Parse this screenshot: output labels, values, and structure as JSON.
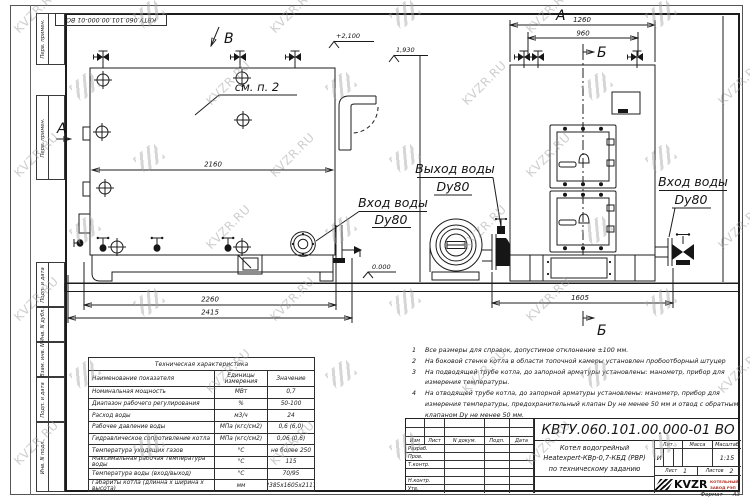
{
  "sheet": {
    "stamp_top": "КВТУ.060.101.00.000-01 ВО",
    "format_label": "Формат",
    "format_value": "А3",
    "margin_labels": [
      "Перв. примен.",
      "Перв. примен.",
      "Подп. и дата",
      "Инв. N дубл.",
      "Взам. инв. N",
      "Подп. и дата",
      "Инв. N подл."
    ]
  },
  "views": {
    "side": {
      "view_b": "В",
      "view_a": "А",
      "see_note": "см. п. 2",
      "dim_2160": "2160",
      "elev_2100": "+2,100",
      "elev_1930": "1,930",
      "inlet_line1": "Вход воды",
      "inlet_line2": "Dy80",
      "elev_zero": "0.000",
      "dim_2260": "2260",
      "dim_2415": "2415"
    },
    "front": {
      "view_a": "А",
      "dim_1260": "1260",
      "dim_960": "960",
      "section_b_top": "Б",
      "section_b_bottom": "Б",
      "outlet_line1": "Выход воды",
      "outlet_line2": "Dy80",
      "inlet_line1": "Вход воды",
      "inlet_line2": "Dy80",
      "dim_1605": "1605"
    }
  },
  "tech_table": {
    "title": "Техническая характеристика",
    "headers": [
      "Наименование показателя",
      "Единицы измерения",
      "Значение"
    ],
    "rows": [
      [
        "Номинальная мощность",
        "МВт",
        "0,7"
      ],
      [
        "Диапазон рабочего регулирования",
        "%",
        "50-100"
      ],
      [
        "Расход воды",
        "м3/ч",
        "24"
      ],
      [
        "Рабочее давление воды",
        "МПа (кгс/см2)",
        "0,6 (6,0)"
      ],
      [
        "Гидравлическое сопротивление котла",
        "МПа (кгс/см2)",
        "0,06 (0,6)"
      ],
      [
        "Температура уходящих газов",
        "°С",
        "не более 250"
      ],
      [
        "Максимальная рабочая температура воды",
        "°С",
        "115"
      ],
      [
        "Температура воды (вход/выход)",
        "°С",
        "70/95"
      ],
      [
        "Габариты котла (длинна х ширина х высота)",
        "мм",
        "2385х1605х2117"
      ]
    ]
  },
  "notes": [
    {
      "num": "1",
      "text": "Все размеры для справок, допустимое отклонение ±100 мм."
    },
    {
      "num": "2",
      "text": "На боковой стенке котла в области топочной камеры установлен пробоотборный штуцер"
    },
    {
      "num": "3",
      "text": "На  подводящей трубе котла, до запорной арматуры установлены: манометр, прибор для измерения температуры."
    },
    {
      "num": "4",
      "text": "На отводящей трубе котла, до запорной арматуры установлены: манометр, прибор для измерения температуры, предохранительный клапан Dy не менее 50 мм и отвод с обратным клапаном Dy не менее 50 мм."
    }
  ],
  "title_block": {
    "doc_number": "КВТУ.060.101.00.000-01  ВО",
    "cols": [
      "Изм",
      "Лист",
      "N докум.",
      "Подп.",
      "Дата"
    ],
    "rows": [
      "Разраб.",
      "Пров.",
      "Т.контр.",
      "Н.контр.",
      "Утв."
    ],
    "name_lines": [
      "Котел водогрейный",
      "Heatexpert-КВр-0,7-КБД (РВР)",
      "по техническому заданию"
    ],
    "lit_header": "Лит.",
    "mass_header": "Масса",
    "scale_header": "Масштаб",
    "lit_value": "И",
    "scale_value": "1:15",
    "sheet_label": "Лист",
    "sheet_value": "1",
    "sheets_label": "Листов",
    "sheets_value": "2",
    "logo_text": "KVZR",
    "logo_sub1": "КОТЕЛЬНЫЙ",
    "logo_sub2": "ЗАВОД РЭП"
  },
  "watermark": {
    "text": "KVZR.RU"
  },
  "colors": {
    "line": "#1c1c1c",
    "logo_red": "#b23324",
    "watermark_gray": "#a3a3a3"
  }
}
